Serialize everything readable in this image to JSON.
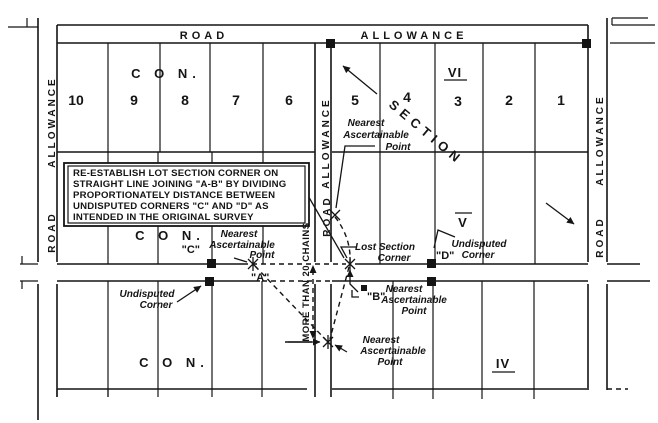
{
  "diagram": {
    "title": "Re-establishment of a lost section corner (survey sketch)",
    "road_label": "ROAD",
    "allowance_label": "ALLOWANCE",
    "section_label": "SECTION",
    "con_label": "C O N.",
    "lots_north_west": [
      "10",
      "9",
      "8",
      "7",
      "6"
    ],
    "lots_north_east": [
      "5",
      "4",
      "3",
      "2",
      "1"
    ],
    "roman_numerals": {
      "vi": "VI",
      "v": "V",
      "iv": "IV"
    },
    "points": {
      "a": "\"A\"",
      "b": "\"B\"",
      "c": "\"C\"",
      "d": "\"D\""
    },
    "instruction_box": {
      "line1": "RE-ESTABLISH LOT SECTION CORNER ON",
      "line2": "STRAIGHT LINE JOINING \"A-B\" BY DIVIDING",
      "line3": "PROPORTIONATELY DISTANCE BETWEEN",
      "line4": "UNDISPUTED CORNERS \"C\" AND \"D\" AS",
      "line5": "INTENDED IN THE ORIGINAL SURVEY"
    },
    "labels": {
      "nearest_ascertainable": {
        "l1": "Nearest",
        "l2": "Ascertainable",
        "l3": "Point"
      },
      "lost_corner": {
        "l1": "Lost Section",
        "l2": "Corner"
      },
      "undisputed": {
        "l1": "Undisputed",
        "l2": "Corner"
      },
      "more_than": "MORE THAN 20 CHAINS"
    }
  }
}
